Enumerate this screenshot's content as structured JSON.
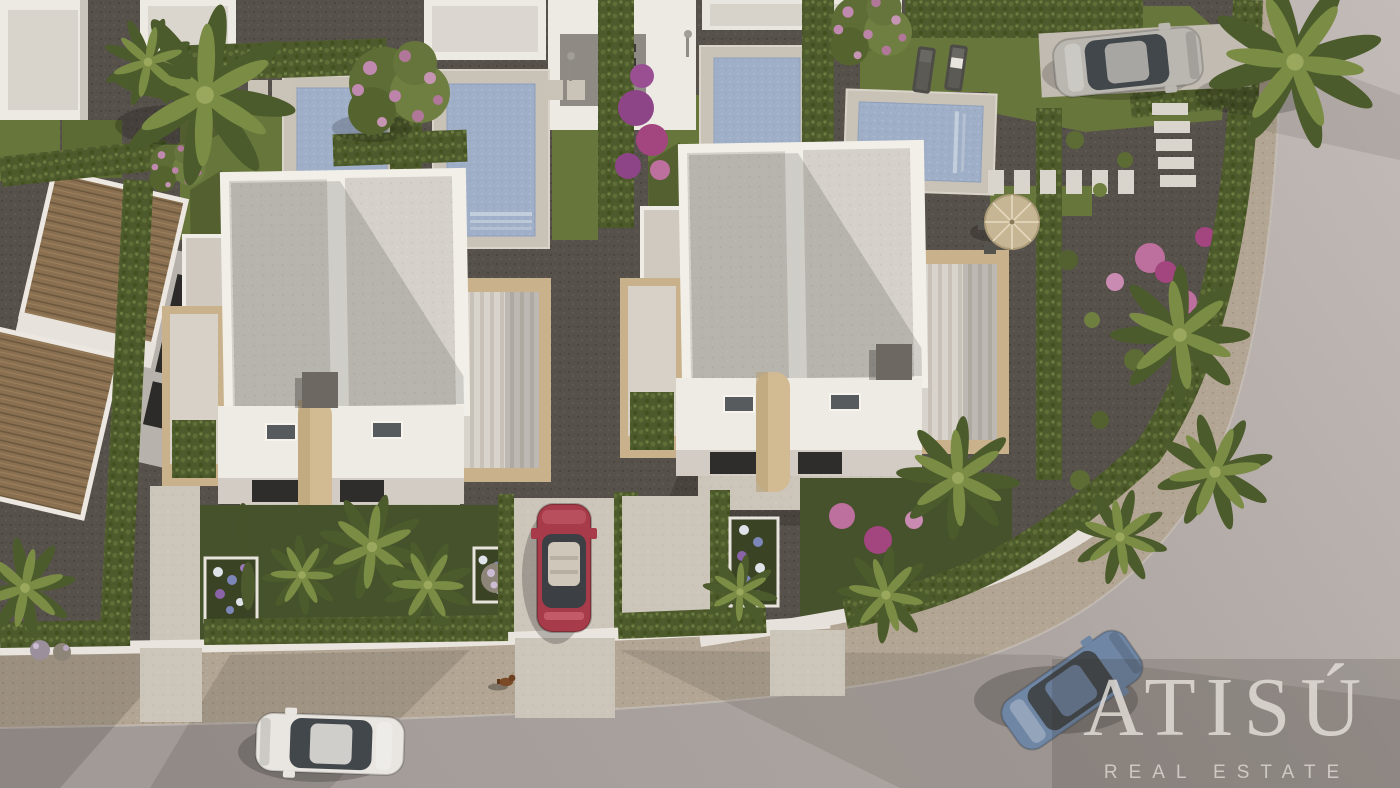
{
  "image": {
    "type": "aerial 3D architectural render",
    "scene": "new-build white semi-detached villas with private pools, gardens, terracotta-roof neighbour house and a curving street"
  },
  "watermark": {
    "brand": "ATISÚ",
    "tagline": "REAL ESTATE"
  },
  "palette": {
    "road": "#aba29e",
    "road_light": "#c0b9b5",
    "sidewalk": "#b2a593",
    "gravel": "#57514b",
    "lawn": "#67763b",
    "lawn_shaded": "#46522b",
    "hedge": "#4d5a2c",
    "pool_water": "#a0afc8",
    "pool_deck": "#c9c2b6",
    "villa_wall": "#f0ede6",
    "villa_roof": "#d5d1ca",
    "travertine": "#c9b28b",
    "terracotta": "#8a7050",
    "flower_pink": "#c273a4",
    "flower_purple": "#8d4587",
    "car_red": "#a83b49",
    "car_blue": "#6f86a4",
    "car_white": "#e9e6e1",
    "car_silver": "#bab7b1",
    "watermark_panel": "rgba(62,55,50,0.20)",
    "watermark_text": "#ddd8d2"
  },
  "objects": {
    "villas": [
      "semi-detached villa left",
      "semi-detached villa right"
    ],
    "pools": 4,
    "cars": [
      "white car on street",
      "red car in driveway",
      "blue car driving on curve",
      "silver car parked top right"
    ],
    "animals": [
      "small dog on sidewalk"
    ],
    "vegetation": [
      "palm trees",
      "cypress hedges",
      "flowering tree",
      "bougainvillea",
      "hydrangea beds",
      "lawns"
    ],
    "features": [
      "terracotta-roof house",
      "stepping-stone stairs",
      "parasol with chairs",
      "sun loungers",
      "outdoor showers",
      "curving street with sidewalk"
    ]
  }
}
